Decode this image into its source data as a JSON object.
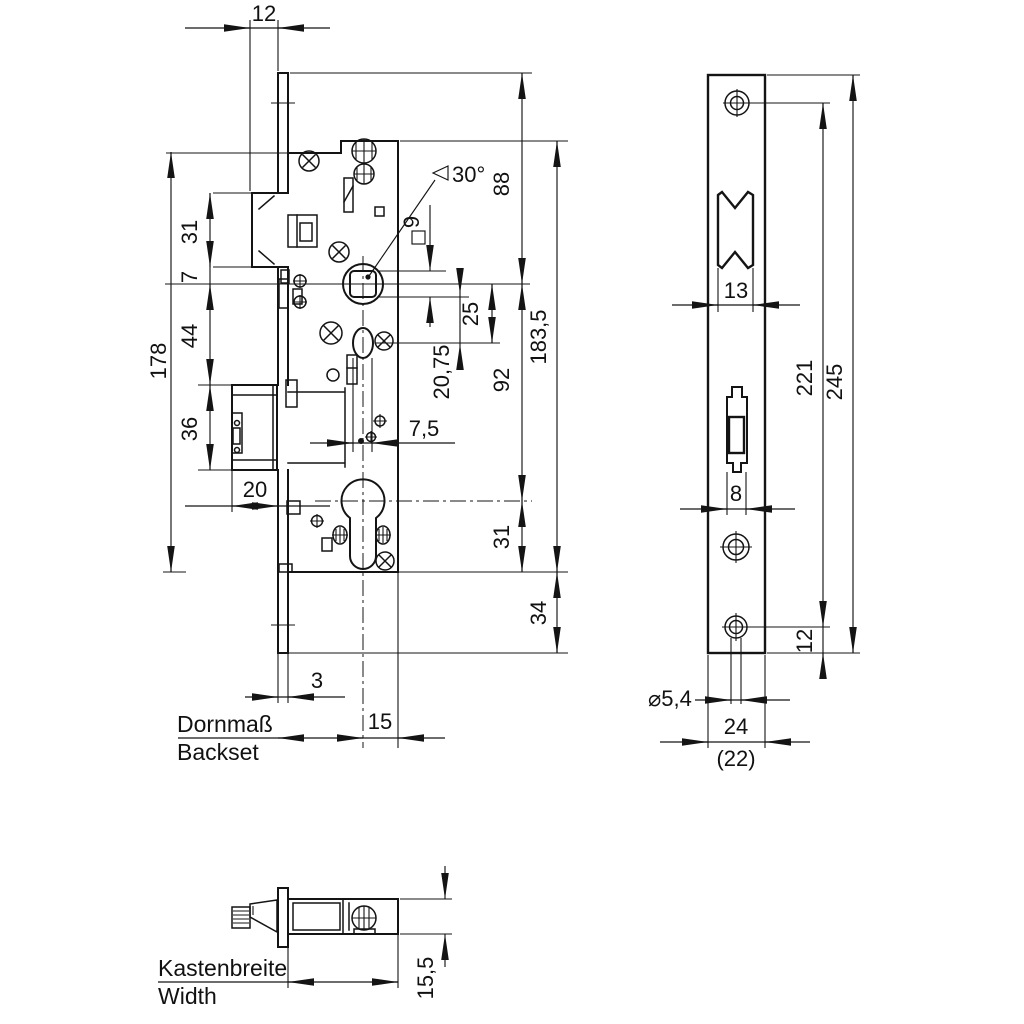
{
  "front_view": {
    "backset_label_de": "Dornmaß",
    "backset_label_en": "Backset",
    "dims": {
      "latch_projection": "12",
      "latch_height": "31",
      "latch_bottom_to_axis": "7",
      "axis_to_bolt_top": "44",
      "bolt_height": "36",
      "case_height": "178",
      "bolt_throw": "20",
      "faceplate_lip": "3",
      "axis_to_case_back": "15",
      "plate_top_to_axis": "88",
      "axis_to_cylinder": "92",
      "cylinder_to_case_bottom": "31",
      "case_total_height": "183,5",
      "case_bottom_to_plate_end": "34",
      "axis_to_oval_hole": "25",
      "square_to_oval_hole": "20,75",
      "oval_hole_width": "7,5",
      "square_size": "9",
      "latch_bevel_angle": "30°"
    }
  },
  "faceplate_view": {
    "dims": {
      "latch_cutout_width": "13",
      "bolt_cutout_width": "8",
      "screw_spacing": "221",
      "plate_length": "245",
      "screw_to_plate_end": "12",
      "screw_hole_diameter": "⌀5,4",
      "plate_width": "24",
      "plate_width_alt": "(22)"
    }
  },
  "top_view": {
    "width_label_de": "Kastenbreite",
    "width_label_en": "Width",
    "dims": {
      "case_thickness": "15,5"
    }
  }
}
